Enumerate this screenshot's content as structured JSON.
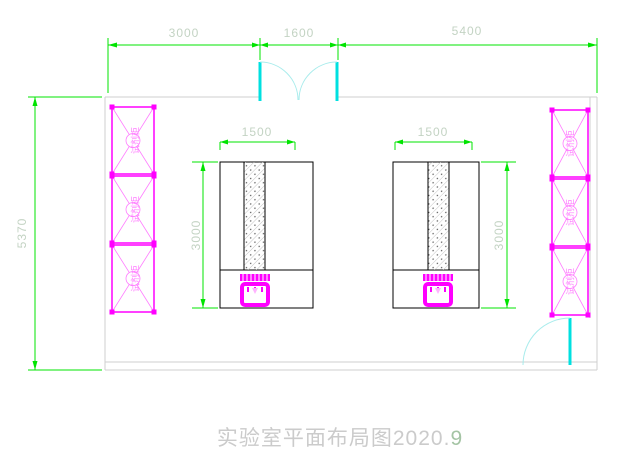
{
  "title": {
    "main": "实验室平面布局图2020.",
    "suffix": "9"
  },
  "dimensions": {
    "top": [
      {
        "label": "3000"
      },
      {
        "label": "1600"
      },
      {
        "label": "5400"
      }
    ],
    "room_height": "5370",
    "bench_left_width": "1500",
    "bench_right_width": "1500",
    "bench_left_depth": "3000",
    "bench_right_depth": "3000"
  },
  "cabinets": {
    "left": [
      {
        "label": "试剂柜"
      },
      {
        "label": "试剂柜"
      },
      {
        "label": "试剂柜"
      }
    ],
    "right": [
      {
        "label": "试剂柜"
      },
      {
        "label": "试剂柜"
      },
      {
        "label": "试剂柜"
      }
    ]
  },
  "colors": {
    "dimension_line": "#00e400",
    "dimension_text": "#c3d3c3",
    "cabinet": "#ff00ff",
    "cabinet_light": "#ff7dff",
    "door": "#00e0e0",
    "door_arc": "#a8ecec",
    "wall": "#cfcfcf",
    "bench": "#000000",
    "sink_accent": "#ffb3ff",
    "title_text": "#cbcbcb",
    "title_suffix": "#a4c4a4"
  }
}
